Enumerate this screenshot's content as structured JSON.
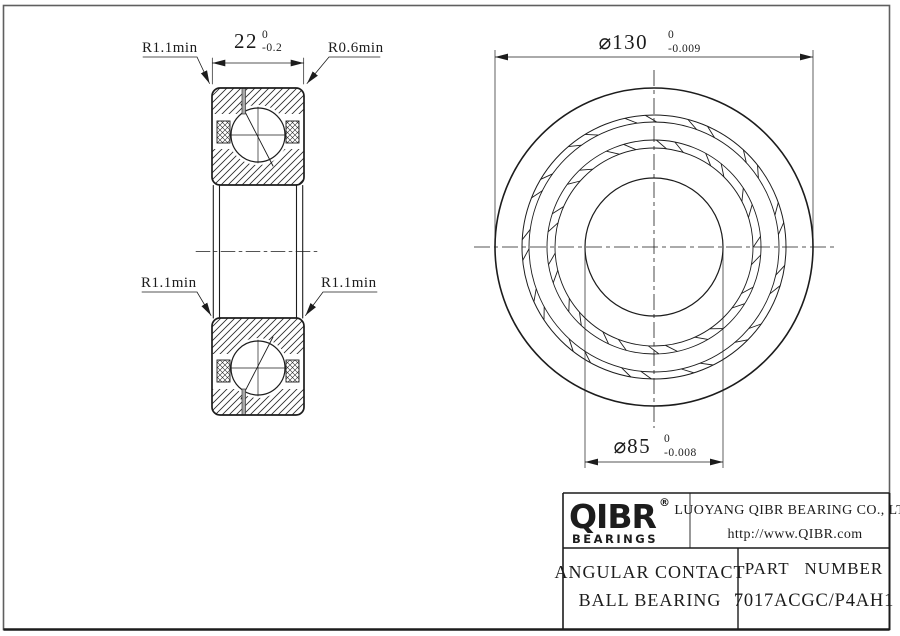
{
  "drawing": {
    "section_view": {
      "radius_top_left": "R1.1min",
      "radius_top_right": "R0.6min",
      "radius_mid_left": "R1.1min",
      "radius_mid_right": "R1.1min",
      "width_dim": {
        "value": "22",
        "tol_upper": "0",
        "tol_lower": "-0.2"
      }
    },
    "front_view": {
      "outer_dia": {
        "symbol": "⌀",
        "value": "130",
        "tol_upper": "0",
        "tol_lower": "-0.009"
      },
      "bore_dia": {
        "symbol": "⌀",
        "value": "85",
        "tol_upper": "0",
        "tol_lower": "-0.008"
      }
    }
  },
  "title_block": {
    "brand": "QIBR",
    "brand_reg": "®",
    "brand_sub": "BEARINGS",
    "company": "LUOYANG QIBR BEARING CO., LTD",
    "website": "http://www.QIBR.com",
    "product_line1": "ANGULAR CONTACT",
    "product_line2": "BALL BEARING",
    "part_label": "PART NUMBER",
    "part_number": "7017ACGC/P4AH1"
  },
  "colors": {
    "line": "#1c1c1c",
    "frame": "#5f5f5f",
    "background": "#ffffff"
  }
}
